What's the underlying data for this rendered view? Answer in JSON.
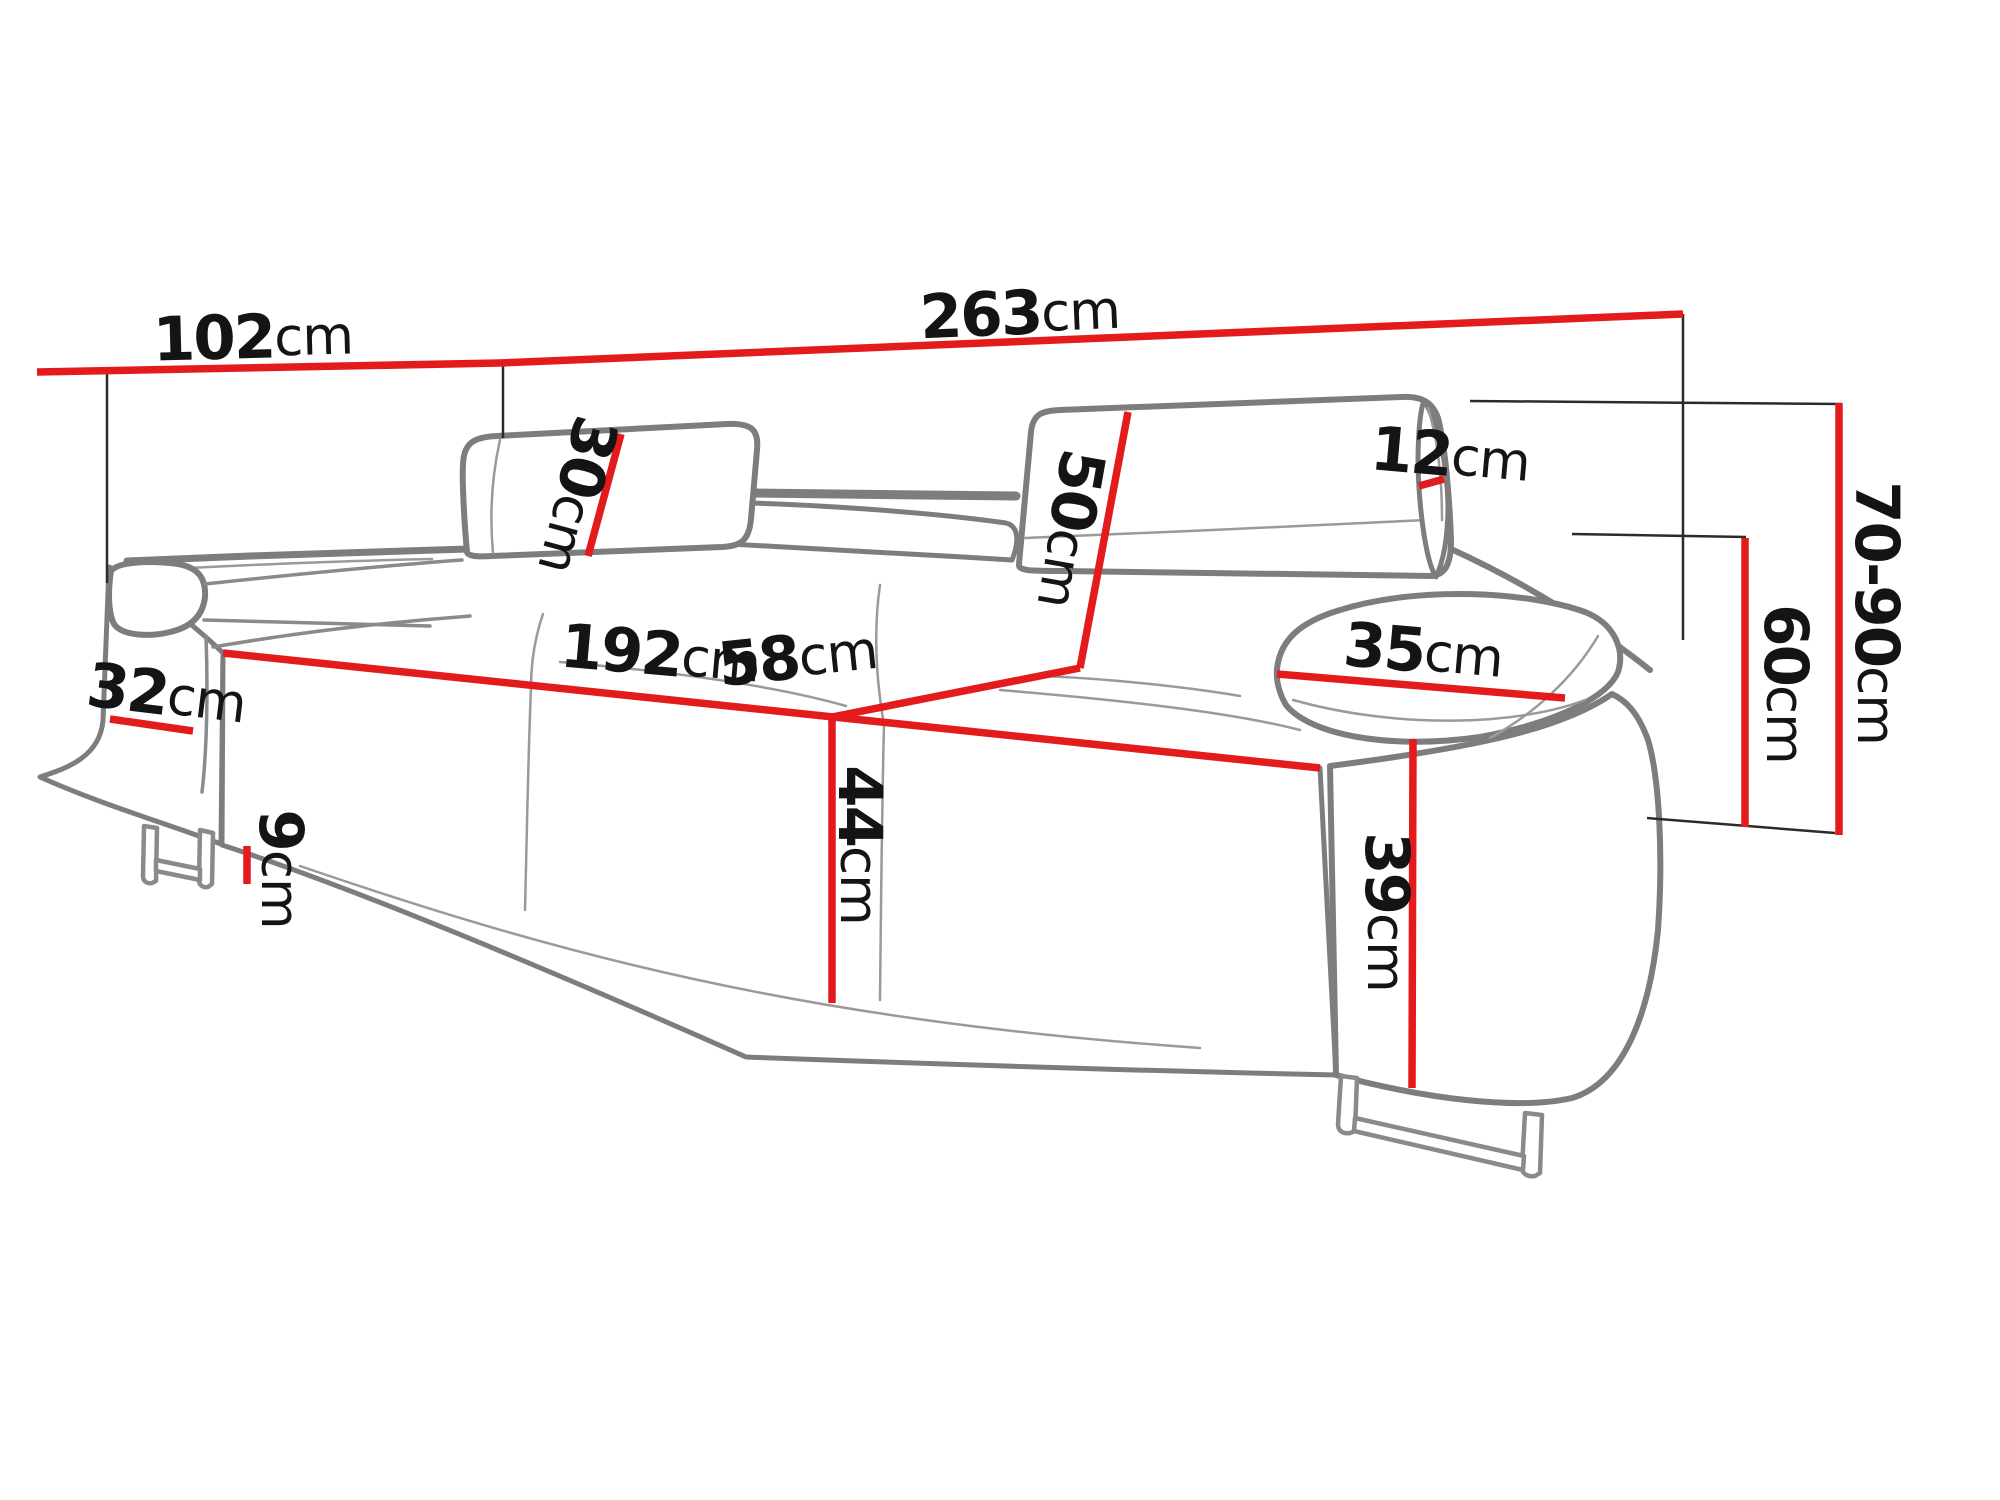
{
  "diagram": {
    "type": "furniture-dimension-diagram",
    "subject": "three-seat sofa line drawing with adjustable headrests and sled legs",
    "unit": "cm",
    "colors": {
      "dimension_line": "#e31b1d",
      "outline": "#7d7d7d",
      "reference_line": "#2b2b2b",
      "text": "#141414",
      "background": "#ffffff"
    },
    "dimensions": {
      "overall_depth": {
        "value": "102",
        "unit": "cm"
      },
      "overall_width": {
        "value": "263",
        "unit": "cm"
      },
      "headrest_height": {
        "value": "30",
        "unit": "cm"
      },
      "headrest_thickness": {
        "value": "12",
        "unit": "cm"
      },
      "backrest_height": {
        "value": "50",
        "unit": "cm"
      },
      "overall_height": {
        "value": "70-90",
        "unit": "cm"
      },
      "seat_width": {
        "value": "192",
        "unit": "cm"
      },
      "seat_depth": {
        "value": "58",
        "unit": "cm"
      },
      "left_armrest_width": {
        "value": "32",
        "unit": "cm"
      },
      "seat_height": {
        "value": "44",
        "unit": "cm"
      },
      "armrest_top_width": {
        "value": "35",
        "unit": "cm"
      },
      "armrest_front_height": {
        "value": "39",
        "unit": "cm"
      },
      "armrest_height": {
        "value": "60",
        "unit": "cm"
      },
      "leg_height": {
        "value": "9",
        "unit": "cm"
      }
    }
  }
}
